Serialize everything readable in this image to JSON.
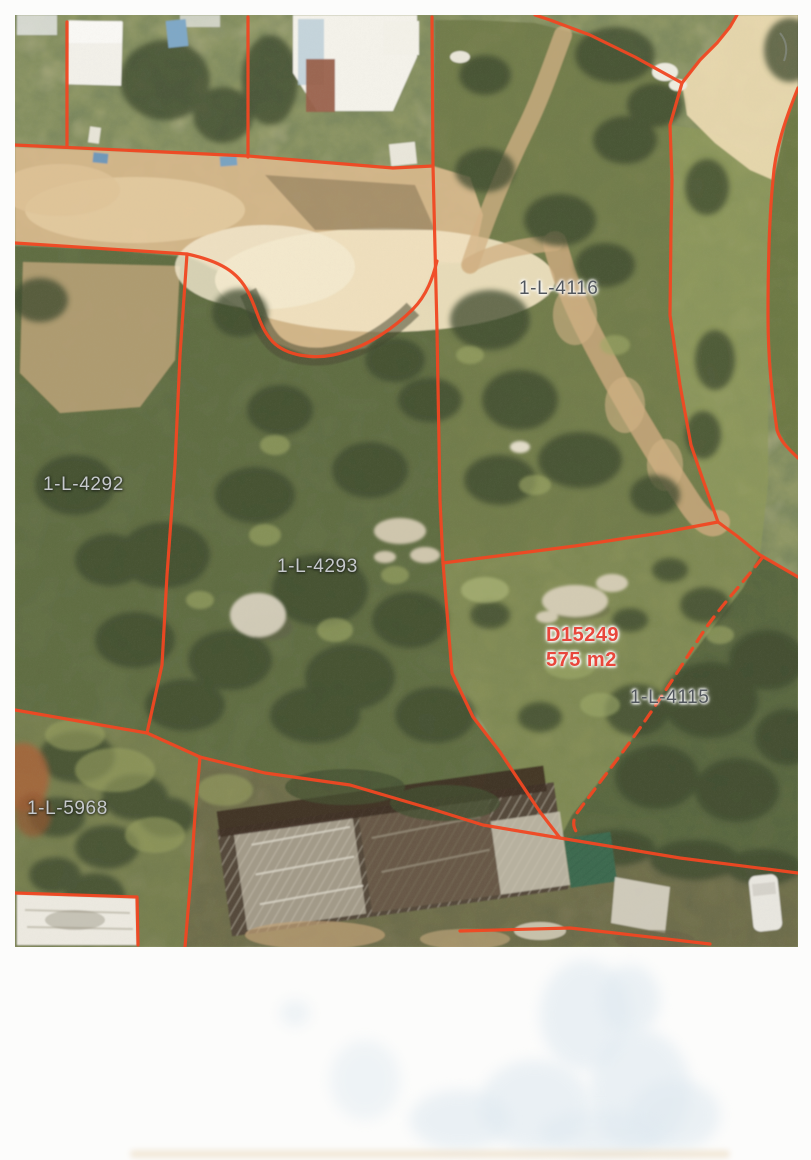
{
  "colors": {
    "parcel_line": "#f14722",
    "subject_label": "#e8473c",
    "parcel_label_dark": "#53585e",
    "parcel_label_light": "#c6c9cc",
    "page_background": "#fcfcfb"
  },
  "photo": {
    "parcel_labels": [
      {
        "name": "1-L-4116",
        "text": "1-L-4116",
        "tone": "dark"
      },
      {
        "name": "1-L-4292",
        "text": "1-L-4292",
        "tone": "light"
      },
      {
        "name": "1-L-4293",
        "text": "1-L-4293",
        "tone": "light"
      },
      {
        "name": "1-L-4115",
        "text": "1-L-4115",
        "tone": "dark"
      },
      {
        "name": "1-L-5968",
        "text": "1-L-5968",
        "tone": "light"
      }
    ],
    "subject": {
      "code": "D15249",
      "area": "575 m2"
    }
  }
}
